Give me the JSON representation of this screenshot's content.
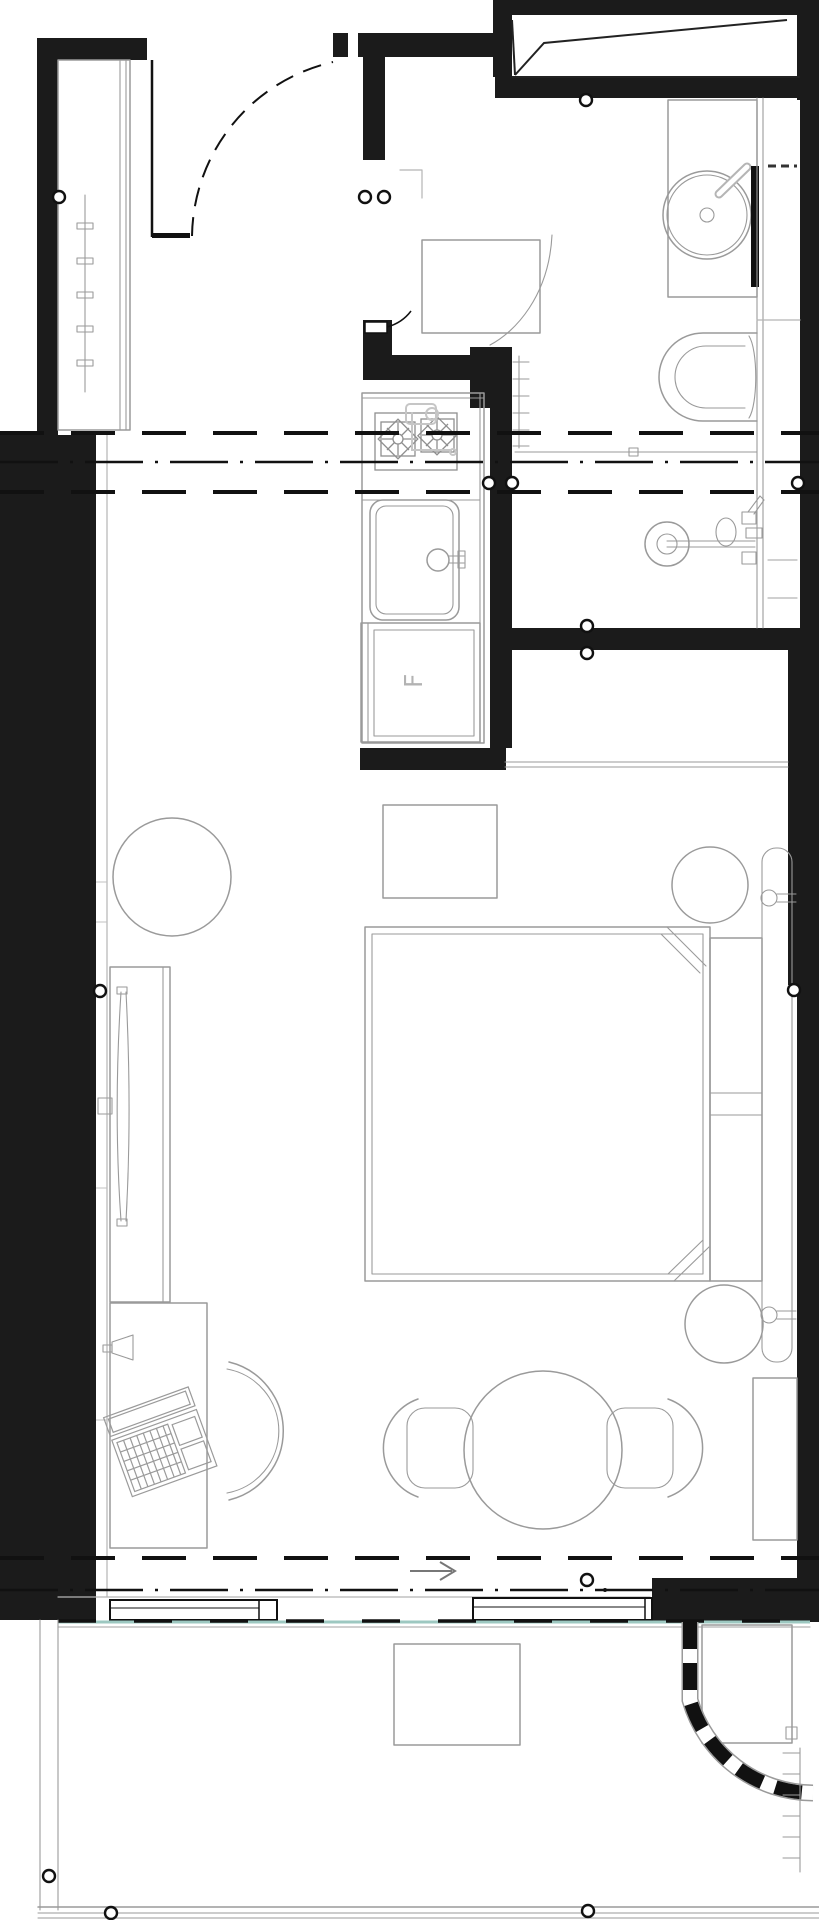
{
  "plan": {
    "fridge_label": "F",
    "icons": {
      "direction_arrow": "right-arrow-icon",
      "door_bumpers": "circle-marker-icon",
      "stove": "two-burner-star-icon"
    },
    "colors": {
      "wall": "#1b1b1b",
      "furn": "#9a9a9a",
      "fix": "#b5b5b5",
      "glass": "#9dc8c1",
      "ref": "#111111",
      "bg": "#ffffff"
    }
  }
}
